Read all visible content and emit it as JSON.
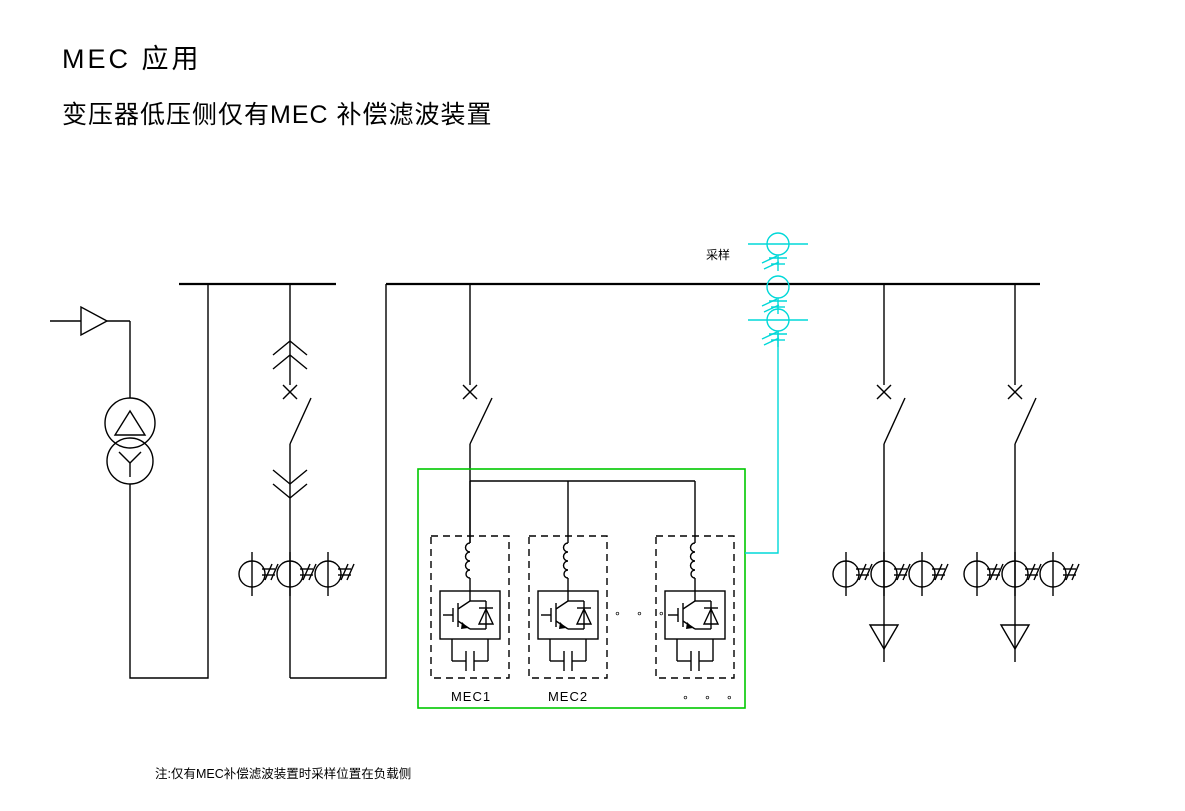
{
  "title": {
    "line1": "MEC 应用",
    "line2": "变压器低压侧仅有MEC 补偿滤波装置"
  },
  "sampling": {
    "label": "采样"
  },
  "mec_panel": {
    "module1_label": "MEC1",
    "module2_label": "MEC2",
    "mid_ellipsis": "∘ ∘ ∘",
    "bottom_ellipsis": "∘ ∘ ∘"
  },
  "note": {
    "text": "注:仅有MEC补偿滤波装置时采样位置在负载侧"
  },
  "colors": {
    "line": "#000000",
    "sampling": "#00d8d8",
    "panel": "#00c800",
    "background": "#ffffff"
  }
}
